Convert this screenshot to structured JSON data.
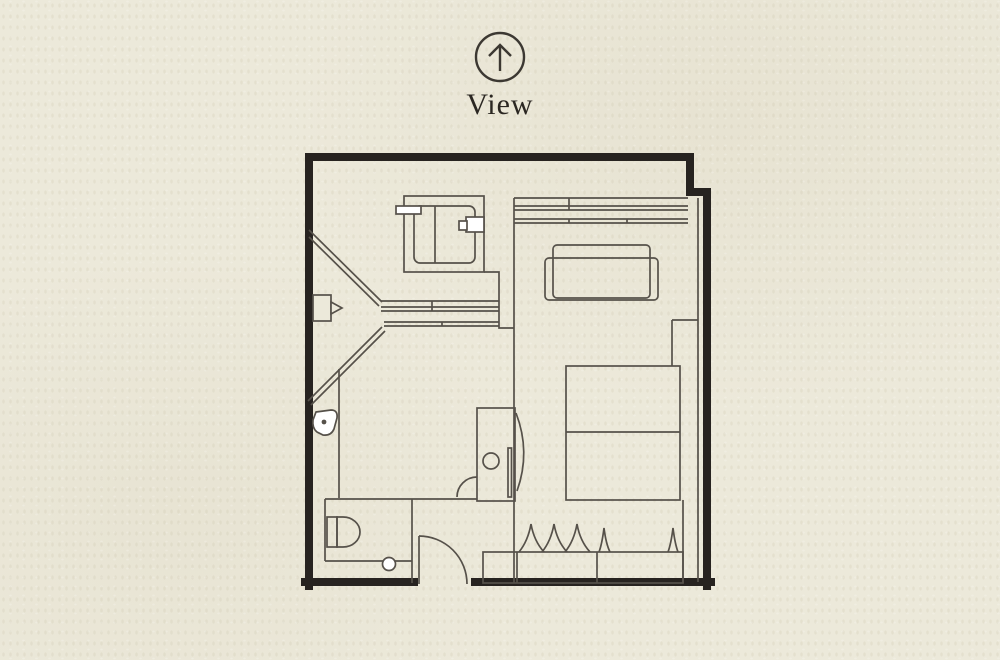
{
  "page": {
    "title_label": "View"
  },
  "compass": {
    "icon": "up-arrow-view-direction-icon"
  },
  "colors": {
    "background": "#ece9da",
    "line": "#56514a",
    "wall": "#272320",
    "text": "#2b2722",
    "white": "#ffffff"
  },
  "floorplan": {
    "type": "hotel-room-floor-plan",
    "rooms": [
      "bathroom",
      "shower",
      "toilet",
      "vanity",
      "bedroom",
      "closet",
      "entrance"
    ],
    "fixtures": [
      "bathtub",
      "shower-drain",
      "wall-shower-fixture",
      "toilet-bowl",
      "washbasin",
      "bed",
      "sofa",
      "window",
      "closet-hangers",
      "entrance-door"
    ]
  }
}
